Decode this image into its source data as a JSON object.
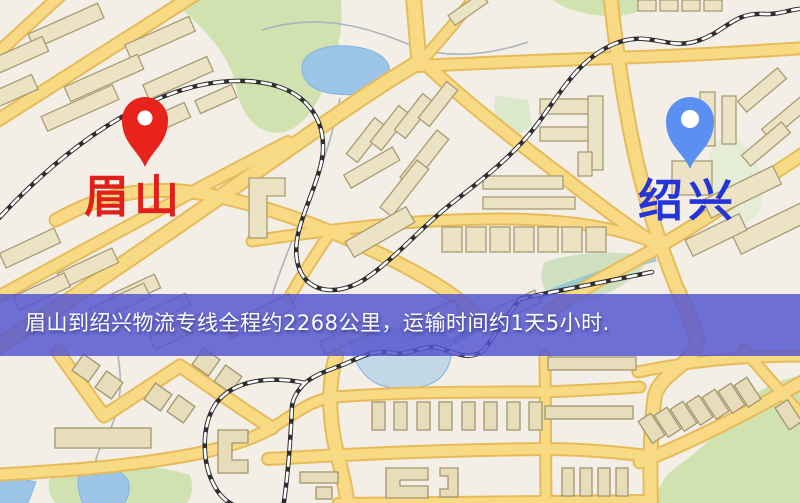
{
  "map": {
    "origin": {
      "label": "眉山",
      "pin_color": "#e8231b",
      "label_color": "#e0211a"
    },
    "destination": {
      "label": "绍兴",
      "pin_color": "#5b8ff2",
      "label_color": "#2434d9"
    },
    "banner": {
      "text": "眉山到绍兴物流专线全程约2268公里，运输时间约1天5小时.",
      "bg_color": "rgba(85,86,208,0.84)",
      "text_color": "#ffffff"
    }
  }
}
